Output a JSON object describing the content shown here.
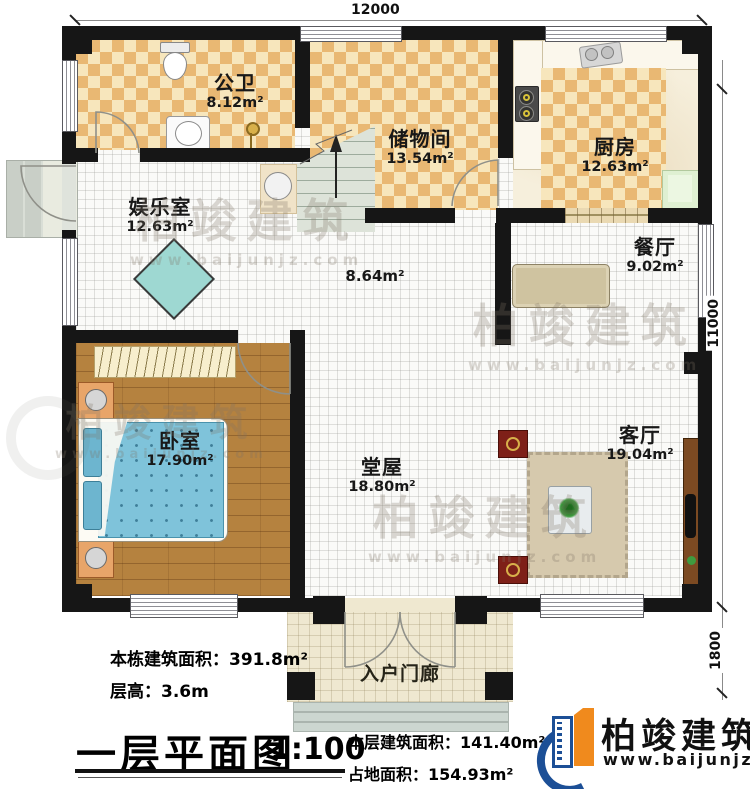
{
  "dimensions": {
    "top_width": "12000",
    "right_height": "11000",
    "porch_height": "1800"
  },
  "rooms": {
    "public_bath": {
      "name": "公卫",
      "area": "8.12m²"
    },
    "storage": {
      "name": "储物间",
      "area": "13.54m²"
    },
    "kitchen": {
      "name": "厨房",
      "area": "12.63m²"
    },
    "entertainment": {
      "name": "娱乐室",
      "area": "12.63m²"
    },
    "dining": {
      "name": "餐厅",
      "area": "9.02m²"
    },
    "hallway": {
      "area": "8.64m²"
    },
    "bedroom": {
      "name": "卧室",
      "area": "17.90m²"
    },
    "main_hall": {
      "name": "堂屋",
      "area": "18.80m²"
    },
    "living_room": {
      "name": "客厅",
      "area": "19.04m²"
    },
    "entry_porch": {
      "name": "入户门廊"
    }
  },
  "title_block": {
    "building_total_area": "本栋建筑面积：391.8m²",
    "floor_height": "层高：3.6m",
    "floor_title": "一层平面图",
    "scale": "1:100",
    "floor_area": "本层建筑面积：141.40m²",
    "footprint_area": "占地面积：154.93m²"
  },
  "brand": {
    "name": "柏竣建筑",
    "website": "www.baijunjz.com"
  },
  "watermark": {
    "name": "柏竣建筑",
    "website": "www.baijunjz.com"
  },
  "colors": {
    "wall": "#161616",
    "checker_dark": "#e9b873",
    "checker_light": "#f7e6bc",
    "wood_floor": "#b5823f",
    "brand_blue": "#1c4f96",
    "brand_orange": "#f08a1d"
  }
}
